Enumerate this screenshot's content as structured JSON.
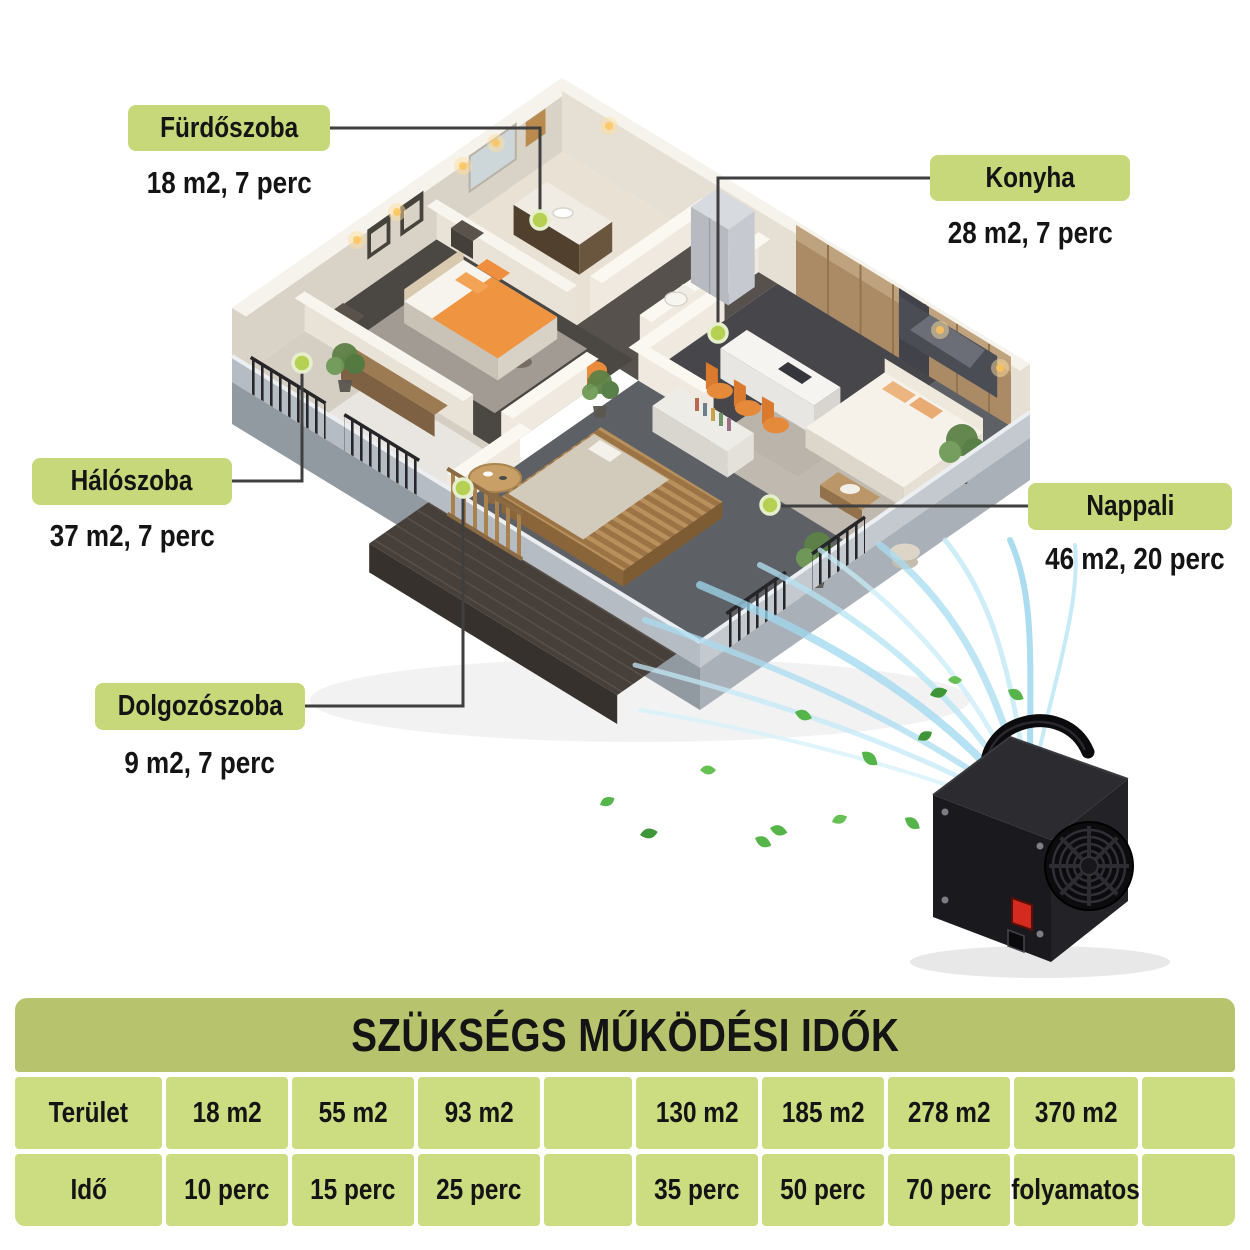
{
  "page": {
    "background": "#ffffff"
  },
  "colors": {
    "label_bg": "#c7d87a",
    "table_title_bg": "#b7c46d",
    "table_cell_bg": "#ccdc80",
    "marker": "#b6d054",
    "connector": "#3f3f3f",
    "airflow": "#9fd8ef",
    "leaf": "#55b54a"
  },
  "floorplan": {
    "rooms": [
      {
        "id": "furdoszoba",
        "name": "Fürdőszoba",
        "detail": "18 m2, 7 perc"
      },
      {
        "id": "konyha",
        "name": "Konyha",
        "detail": "28 m2, 7 perc"
      },
      {
        "id": "haloszoba",
        "name": "Hálószoba",
        "detail": "37 m2, 7 perc"
      },
      {
        "id": "nappali",
        "name": "Nappali",
        "detail": "46 m2, 20 perc"
      },
      {
        "id": "dolgozoszoba",
        "name": "Dolgozószoba",
        "detail": "9 m2, 7 perc"
      }
    ]
  },
  "device": {
    "icon": "ozone-generator-device"
  },
  "table": {
    "title": "SZÜKSÉGS MŰKÖDÉSI IDŐK",
    "rows": [
      {
        "cells": [
          "Terület",
          "18 m2",
          "55 m2",
          "93 m2",
          "",
          "130 m2",
          "185 m2",
          "278 m2",
          "370 m2",
          ""
        ]
      },
      {
        "cells": [
          "Idő",
          "10 perc",
          "15 perc",
          "25 perc",
          "",
          "35 perc",
          "50 perc",
          "70 perc",
          "folyamatos",
          ""
        ]
      }
    ]
  }
}
